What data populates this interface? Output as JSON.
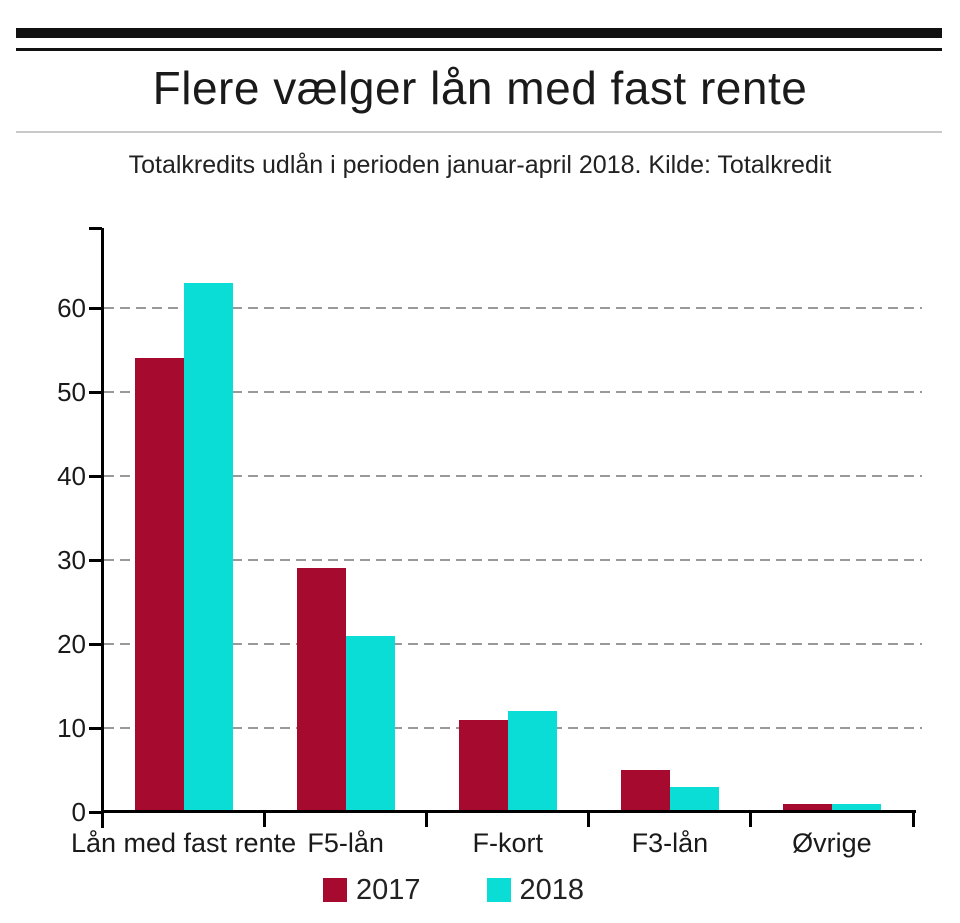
{
  "title": "Flere vælger lån med fast rente",
  "subtitle": "Totalkredits udlån i perioden januar-april 2018. Kilde: Totalkredit",
  "colors": {
    "series_2017": "#A60A2E",
    "series_2018": "#0ADCD6",
    "axis": "#000000",
    "grid": "#999999",
    "text": "#1a1a1a",
    "divider": "#c9c9c9"
  },
  "chart_data": {
    "type": "bar",
    "title": "Flere vælger lån med fast rente",
    "subtitle": "Totalkredits udlån i perioden januar-april 2018. Kilde: Totalkredit",
    "categories": [
      "Lån med fast rente",
      "F5-lån",
      "F-kort",
      "F3-lån",
      "Øvrige"
    ],
    "series": [
      {
        "name": "2017",
        "color": "#A60A2E",
        "values": [
          54,
          29,
          11,
          5,
          1
        ]
      },
      {
        "name": "2018",
        "color": "#0ADCD6",
        "values": [
          63,
          21,
          12,
          3,
          1
        ]
      }
    ],
    "xlabel": "",
    "ylabel": "",
    "ylim": [
      0,
      70
    ],
    "yticks": [
      0,
      10,
      20,
      30,
      40,
      50,
      60
    ],
    "grid": "horizontal-dashed",
    "legend_position": "bottom"
  }
}
